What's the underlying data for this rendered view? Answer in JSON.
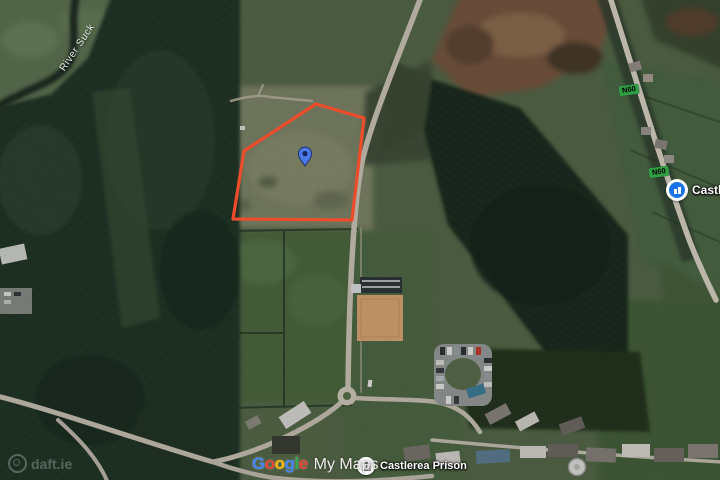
{
  "map": {
    "kind": "satellite",
    "labels": {
      "river": "River Suck",
      "town": "Castlerea",
      "prison": "Castlerea Prison",
      "shield_n60": "N60"
    },
    "watermarks": {
      "google": {
        "letters": [
          {
            "ch": "G",
            "color": "#4285F4"
          },
          {
            "ch": "o",
            "color": "#EA4335"
          },
          {
            "ch": "o",
            "color": "#FBBC05"
          },
          {
            "ch": "g",
            "color": "#4285F4"
          },
          {
            "ch": "l",
            "color": "#34A853"
          },
          {
            "ch": "e",
            "color": "#EA4335"
          }
        ],
        "suffix": "My Maps"
      },
      "daft": "daft.ie"
    },
    "colors": {
      "boundary_red": "#ED4C2B",
      "marker_blue": "#4B79E8",
      "marker_dot": "#16235C",
      "shield_green": "#2F9E44",
      "shield_text": "#FFDE59"
    }
  }
}
